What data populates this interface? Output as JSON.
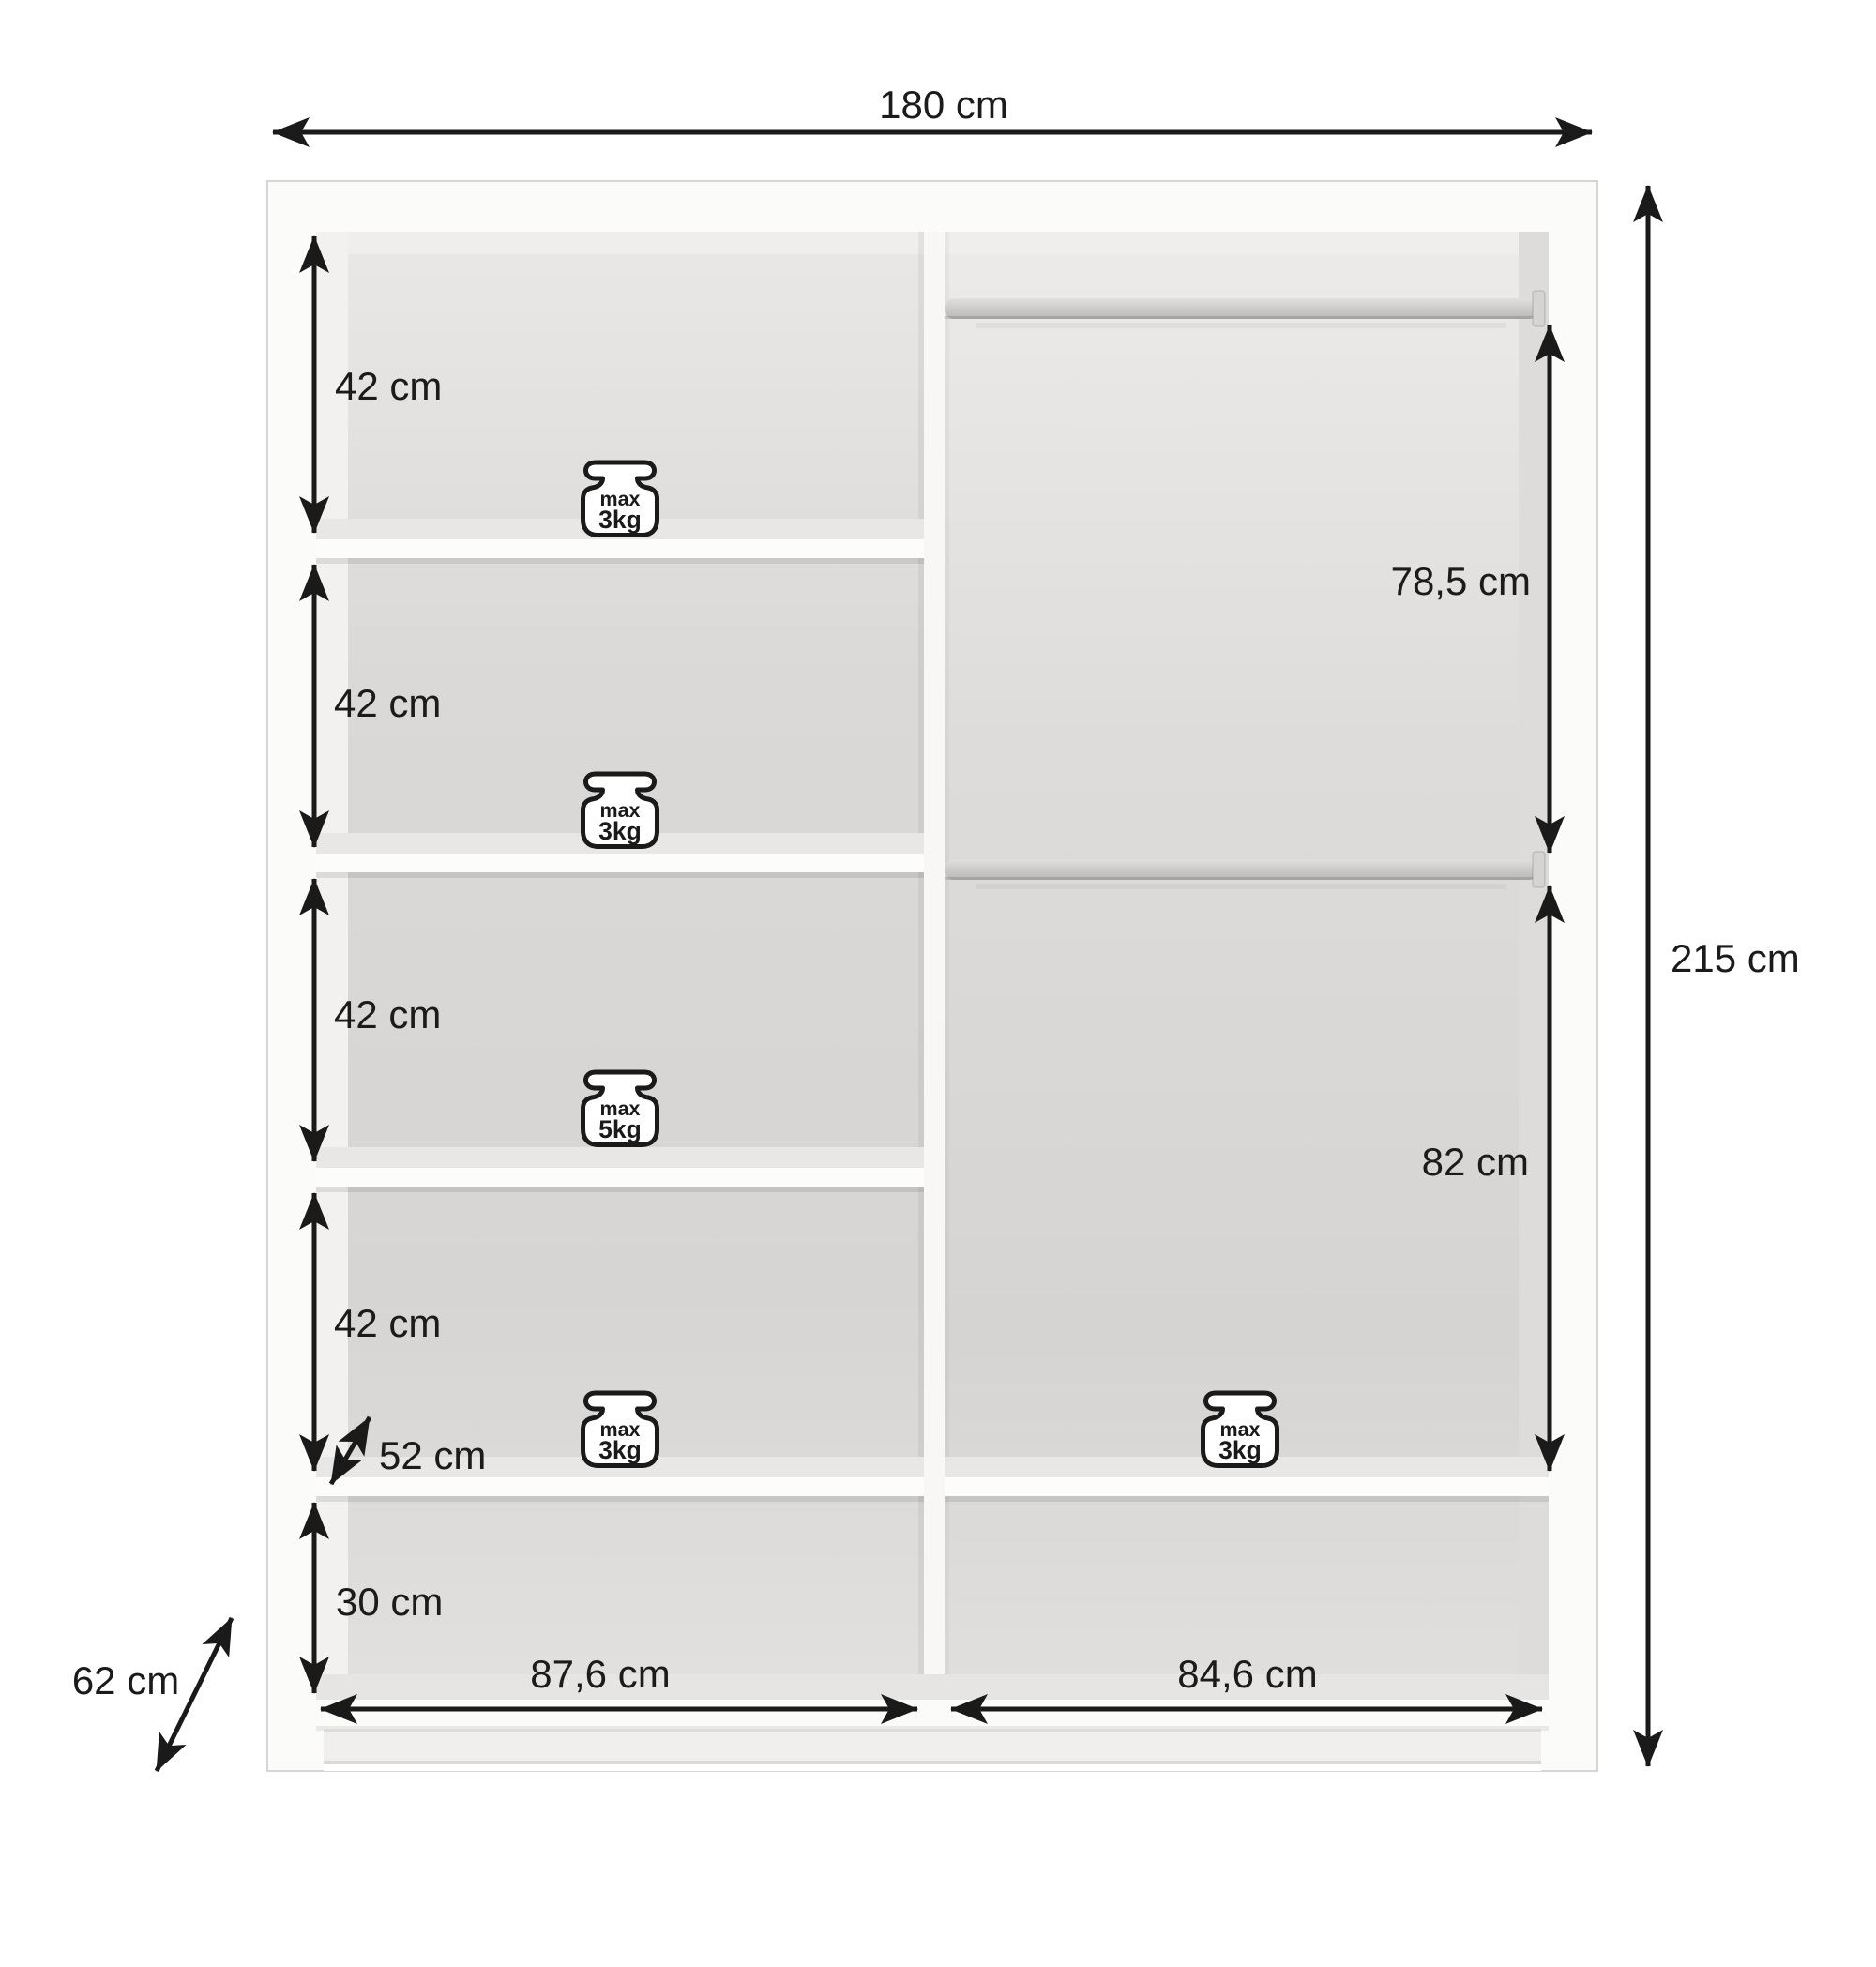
{
  "page": {
    "background": "#ffffff",
    "ink": "#1b1b1b",
    "description": "Wardrobe interior dimensions diagram"
  },
  "wardrobe": {
    "overall": {
      "width_label": "180 cm",
      "height_label": "215 cm",
      "depth_label": "62 cm"
    },
    "left_sections": [
      {
        "label": "42 cm"
      },
      {
        "label": "42 cm"
      },
      {
        "label": "42 cm"
      },
      {
        "label": "42 cm"
      },
      {
        "label": "30 cm"
      }
    ],
    "shelf_depth_label": "52 cm",
    "hanging_spaces": {
      "upper_label": "78,5 cm",
      "lower_label": "82 cm"
    },
    "compartment_widths": {
      "left_label": "87,6 cm",
      "right_label": "84,6 cm"
    },
    "weight_badges": [
      {
        "prefix": "max",
        "value": "3kg"
      },
      {
        "prefix": "max",
        "value": "3kg"
      },
      {
        "prefix": "max",
        "value": "5kg"
      },
      {
        "prefix": "max",
        "value": "3kg"
      },
      {
        "prefix": "max",
        "value": "3kg"
      }
    ]
  }
}
